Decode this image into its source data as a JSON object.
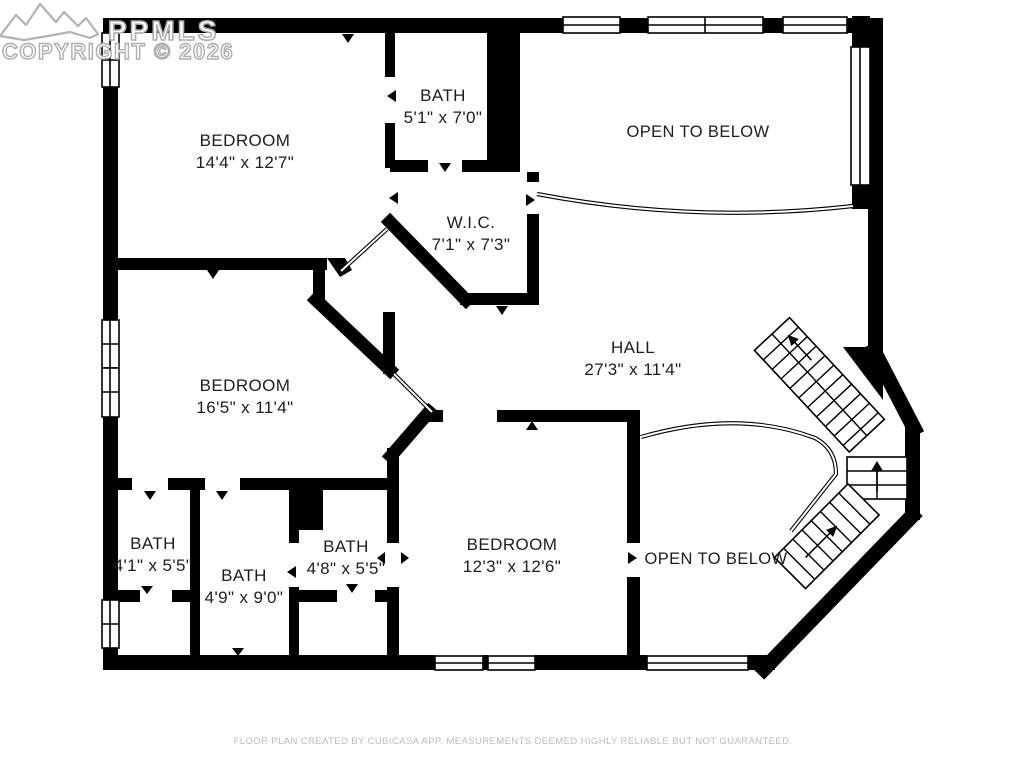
{
  "watermark": {
    "logo": "mountain-logo",
    "line1": "PPMLS",
    "line2": "COPYRIGHT © 2026"
  },
  "rooms": [
    {
      "id": "bedroom-1",
      "name": "BEDROOM",
      "dims": "14'4\" x 12'7\""
    },
    {
      "id": "bath-upper",
      "name": "BATH",
      "dims": "5'1\" x 7'0\""
    },
    {
      "id": "wic",
      "name": "W.I.C.",
      "dims": "7'1\" x 7'3\""
    },
    {
      "id": "open-to-below-upper",
      "name": "OPEN TO BELOW",
      "dims": ""
    },
    {
      "id": "hall",
      "name": "HALL",
      "dims": "27'3\" x 11'4\""
    },
    {
      "id": "bedroom-2",
      "name": "BEDROOM",
      "dims": "16'5\" x 11'4\""
    },
    {
      "id": "bath-1",
      "name": "BATH",
      "dims": "4'1\" x 5'5\""
    },
    {
      "id": "bath-2",
      "name": "BATH",
      "dims": "4'9\" x 9'0\""
    },
    {
      "id": "bath-3",
      "name": "BATH",
      "dims": "4'8\" x 5'5\""
    },
    {
      "id": "bedroom-3",
      "name": "BEDROOM",
      "dims": "12'3\" x 12'6\""
    },
    {
      "id": "open-to-below-lower",
      "name": "OPEN TO BELOW",
      "dims": ""
    }
  ],
  "footer": {
    "text": "FLOOR PLAN CREATED BY CUBICASA APP. MEASUREMENTS DEEMED HIGHLY RELIABLE BUT NOT GUARANTEED."
  },
  "colors": {
    "wall": "#000000",
    "background": "#ffffff",
    "label_text": "#1e1e1e",
    "watermark": "#aeaeae",
    "footer_text": "#bcbcbc"
  }
}
